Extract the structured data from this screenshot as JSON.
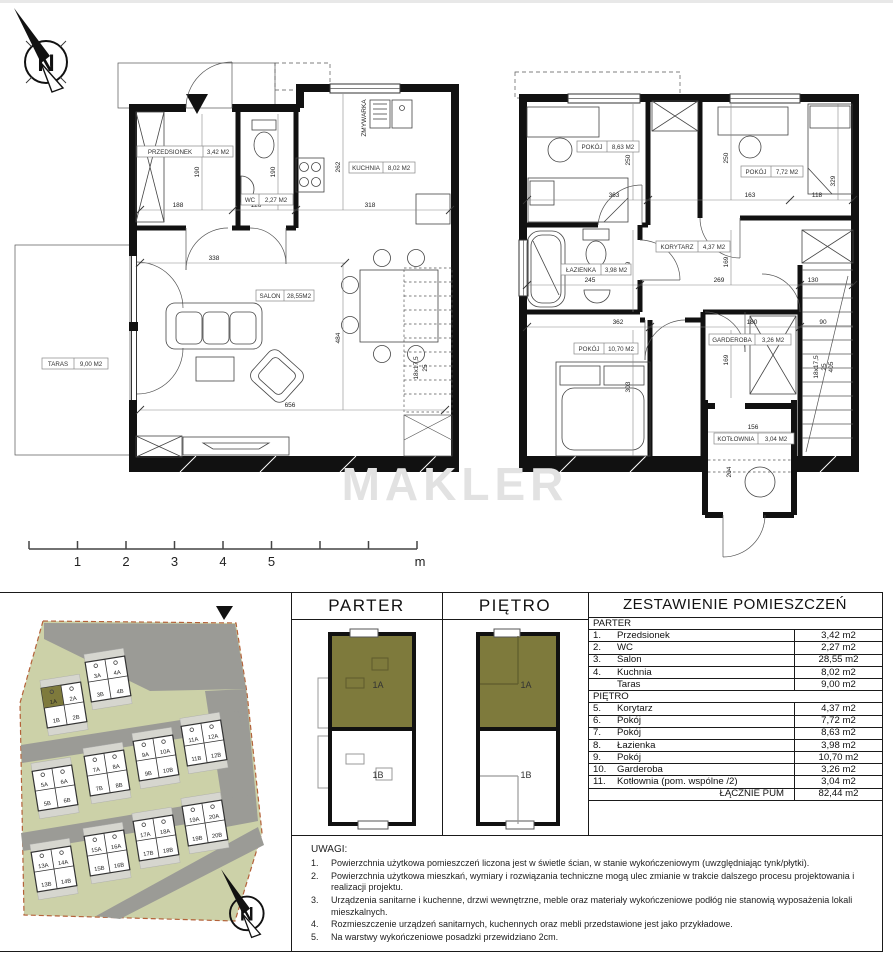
{
  "watermark": "MAKLER",
  "compass": {
    "letter": "N"
  },
  "scale": {
    "ticks": [
      "1",
      "2",
      "3",
      "4",
      "5"
    ],
    "unit": "m"
  },
  "gf": {
    "przedsionek": {
      "name": "PRZEDSIONEK",
      "area": "3,42 M2"
    },
    "wc": {
      "name": "WC",
      "area": "2,27 M2"
    },
    "kuchnia": {
      "name": "KUCHNIA",
      "area": "8,02 M2"
    },
    "salon": {
      "name": "SALON",
      "area": "28,55M2"
    },
    "taras": {
      "name": "TARAS",
      "area": "9,00 M2"
    },
    "zmywarka": "ZMYWARKA",
    "stairs": {
      "a": "18x17,5",
      "b": "25"
    },
    "dims": {
      "d188": "188",
      "d126": "126",
      "d190a": "190",
      "d190b": "190",
      "d262": "262",
      "d318": "318",
      "d338": "338",
      "d484": "484",
      "d656": "656"
    }
  },
  "ff": {
    "pokoj1": {
      "name": "POKÓJ",
      "area": "8,63 M2"
    },
    "pokoj2": {
      "name": "POKÓJ",
      "area": "7,72 M2"
    },
    "korytarz": {
      "name": "KORYTARZ",
      "area": "4,37 M2"
    },
    "lazienka": {
      "name": "ŁAZIENKA",
      "area": "3,98 M2"
    },
    "pokoj3": {
      "name": "POKÓJ",
      "area": "10,70 M2"
    },
    "garderoba": {
      "name": "GARDEROBA",
      "area": "3,26 M2"
    },
    "kotlownia": {
      "name": "KOTŁOWNIA",
      "area": "3,04 M2"
    },
    "stairs": {
      "a": "18x17,5",
      "b": "25",
      "c": "405"
    },
    "dims": {
      "d363": "363",
      "d250a": "250",
      "d250b": "250",
      "d163": "163",
      "d118": "118",
      "d329": "329",
      "d245": "245",
      "d169a": "169",
      "d269": "269",
      "d169b": "169",
      "d130": "130",
      "d362": "362",
      "d303": "303",
      "d180": "180",
      "d169c": "169",
      "d90": "90",
      "d156": "156",
      "d204": "204"
    }
  },
  "site": {
    "blocks": [
      {
        "u": [
          "1A",
          "2A",
          "1B",
          "2B"
        ]
      },
      {
        "u": [
          "3A",
          "4A",
          "3B",
          "4B"
        ]
      },
      {
        "u": [
          "5A",
          "6A",
          "5B",
          "6B"
        ]
      },
      {
        "u": [
          "7A",
          "8A",
          "7B",
          "8B"
        ]
      },
      {
        "u": [
          "9A",
          "10A",
          "9B",
          "10B"
        ]
      },
      {
        "u": [
          "11A",
          "12A",
          "11B",
          "12B"
        ]
      },
      {
        "u": [
          "13A",
          "14A",
          "13B",
          "14B"
        ]
      },
      {
        "u": [
          "15A",
          "16A",
          "15B",
          "16B"
        ]
      },
      {
        "u": [
          "17A",
          "18A",
          "17B",
          "18B"
        ]
      },
      {
        "u": [
          "19A",
          "20A",
          "19B",
          "20B"
        ]
      }
    ]
  },
  "panels": {
    "parter": {
      "title": "PARTER",
      "ua": "1A",
      "ub": "1B"
    },
    "pietro": {
      "title": "PIĘTRO",
      "ua": "1A",
      "ub": "1B"
    }
  },
  "table": {
    "title": "ZESTAWIENIE POMIESZCZEŃ",
    "rows": [
      {
        "no": "",
        "name": "PARTER",
        "val": ""
      },
      {
        "no": "1.",
        "name": "Przedsionek",
        "val": "3,42 m2"
      },
      {
        "no": "2.",
        "name": "WC",
        "val": "2,27 m2"
      },
      {
        "no": "3.",
        "name": "Salon",
        "val": "28,55 m2"
      },
      {
        "no": "4.",
        "name": "Kuchnia",
        "val": "8,02 m2"
      },
      {
        "no": "",
        "name": "Taras",
        "val": "9,00 m2"
      },
      {
        "no": "",
        "name": "PIĘTRO",
        "val": ""
      },
      {
        "no": "5.",
        "name": "Korytarz",
        "val": "4,37 m2"
      },
      {
        "no": "6.",
        "name": "Pokój",
        "val": "7,72 m2"
      },
      {
        "no": "7.",
        "name": "Pokój",
        "val": "8,63 m2"
      },
      {
        "no": "8.",
        "name": "Łazienka",
        "val": "3,98 m2"
      },
      {
        "no": "9.",
        "name": "Pokój",
        "val": "10,70 m2"
      },
      {
        "no": "10.",
        "name": "Garderoba",
        "val": "3,26 m2"
      },
      {
        "no": "11.",
        "name": "Kotłownia (pom. wspólne /2)",
        "val": "3,04 m2"
      },
      {
        "no": "",
        "name": "ŁĄCZNIE PUM",
        "val": "82,44 m2"
      }
    ]
  },
  "notes": {
    "title": "UWAGI:",
    "items": [
      {
        "no": "1.",
        "text": "Powierzchnia użytkowa pomieszczeń liczona jest w świetle ścian, w stanie wykończeniowym (uwzględniając tynk/płytki)."
      },
      {
        "no": "2.",
        "text": "Powierzchnia użytkowa mieszkań, wymiary i rozwiązania techniczne mogą ulec zmianie w trakcie dalszego procesu projektowania i realizacji projektu."
      },
      {
        "no": "3.",
        "text": "Urządzenia sanitarne i kuchenne, drzwi wewnętrzne, meble oraz materiały wykończeniowe podłóg nie stanowią wyposażenia lokali mieszkalnych."
      },
      {
        "no": "4.",
        "text": "Rozmieszczenie urządzeń sanitarnych, kuchennych oraz mebli przedstawione jest jako przykładowe."
      },
      {
        "no": "5.",
        "text": "Na warstwy wykończeniowe posadzki przewidziano 2cm."
      }
    ]
  }
}
